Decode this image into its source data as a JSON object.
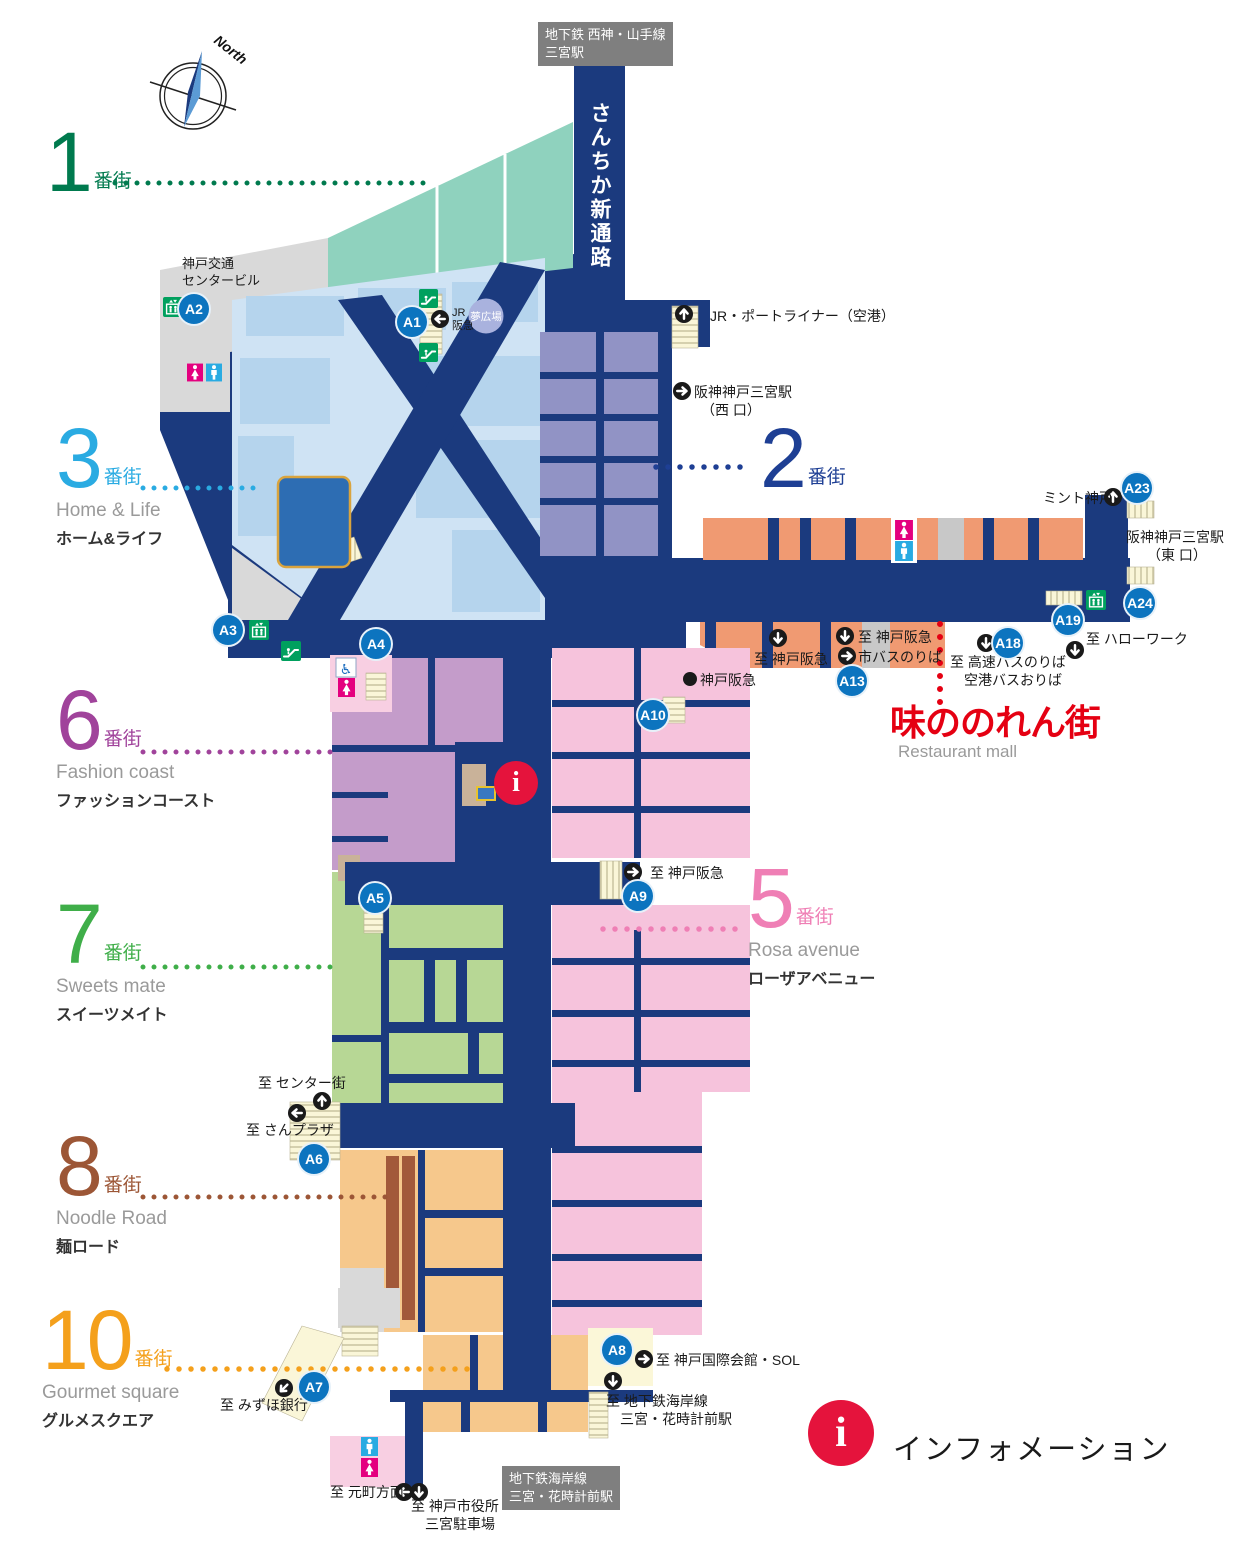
{
  "compass": {
    "label": "North"
  },
  "stations": {
    "subway_top": "地下鉄 西神・山手線\n三宮駅",
    "corridor": "さんちか新通路",
    "kotsu_center": "神戸交通\nセンタービル",
    "jr_portliner": "JR・ポートライナー（空港）",
    "hanshin_west": "阪神神戸三宮駅\n　（西 口）",
    "hanshin_east": "阪神神戸三宮駅\n　　（東 口）",
    "mint": "ミント神戸",
    "subway_bottom": "地下鉄海岸線\n三宮・花時計前駅",
    "yume_plaza": "夢広場",
    "jr_hankyu": "JR\n阪急",
    "hankyu_store": "神戸阪急"
  },
  "exits": {
    "hello_work": "至 ハローワーク",
    "highway_bus": "至 高速バスのりば\n　空港バスおりば",
    "to_hankyu_west": "至 神戸阪急",
    "to_hankyu_center": "至 神戸阪急",
    "city_bus": "市バスのりば",
    "to_hankyu_east": "至 神戸阪急",
    "center_gai": "至 センター街",
    "san_plaza": "至 さんプラザ",
    "mizuho": "至 みずほ銀行",
    "kokusai": "至 神戸国際会館・SOL",
    "kaigan_line": "至 地下鉄海岸線\n　三宮・花時計前駅",
    "motomachi": "至 元町方面",
    "city_hall": "至 神戸市役所\n　三宮駐車場"
  },
  "restaurant_mall": {
    "title": "味ののれん街",
    "subtitle": "Restaurant mall"
  },
  "info": {
    "i": "i",
    "label": "インフォメーション"
  },
  "districts": {
    "d1": {
      "num": "1",
      "suffix": "番街",
      "color": "#007a4e"
    },
    "d2": {
      "num": "2",
      "suffix": "番街",
      "color": "#1e3f94"
    },
    "d3": {
      "num": "3",
      "suffix": "番街",
      "en": "Home & Life",
      "jp": "ホーム&ライフ",
      "color": "#2aabe2"
    },
    "d5": {
      "num": "5",
      "suffix": "番街",
      "en": "Rosa avenue",
      "jp": "ローザアベニュー",
      "color": "#ef7fb5"
    },
    "d6": {
      "num": "6",
      "suffix": "番街",
      "en": "Fashion coast",
      "jp": "ファッションコースト",
      "color": "#a0439b"
    },
    "d7": {
      "num": "7",
      "suffix": "番街",
      "en": "Sweets mate",
      "jp": "スイーツメイト",
      "color": "#3fae49"
    },
    "d8": {
      "num": "8",
      "suffix": "番街",
      "en": "Noodle Road",
      "jp": "麺ロード",
      "color": "#9c5636"
    },
    "d10": {
      "num": "10",
      "suffix": "番街",
      "en": "Gourmet square",
      "jp": "グルメスクエア",
      "color": "#f4a01c"
    }
  },
  "badges": {
    "a1": "A1",
    "a2": "A2",
    "a3": "A3",
    "a4": "A4",
    "a5": "A5",
    "a6": "A6",
    "a7": "A7",
    "a8": "A8",
    "a9": "A9",
    "a10": "A10",
    "a13": "A13",
    "a18": "A18",
    "a19": "A19",
    "a23": "A23",
    "a24": "A24"
  },
  "colors": {
    "corridor_navy": "#1b3a7e",
    "district1_teal": "#8fd2be",
    "district2_slate": "#9193c5",
    "district3_blue": "#cfe3f4",
    "district5_pink": "#f6c3dc",
    "district6_purple": "#c49cca",
    "district7_green": "#b7d795",
    "district8_orange": "#f6c88c",
    "restaurant_salmon": "#f09a72",
    "badge_blue": "#0c74bf",
    "info_red": "#e5133c",
    "accent_red": "#e50012"
  }
}
